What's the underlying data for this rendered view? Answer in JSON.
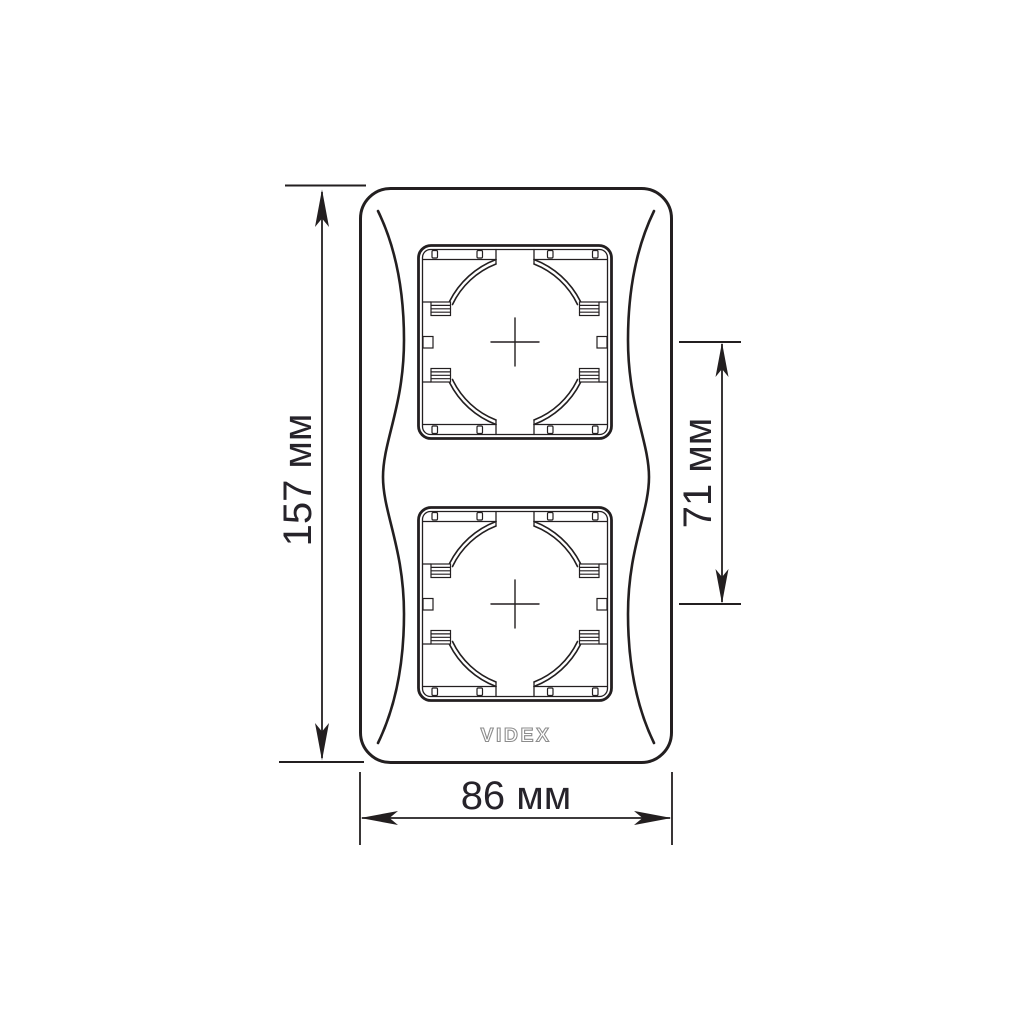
{
  "diagram": {
    "brand": "VIDEX",
    "subject": "2-gang vertical frame dimension drawing",
    "aperture_count": 2,
    "labels": {
      "height": "157 мм",
      "spacing": "71 мм",
      "width": "86 мм"
    },
    "colors": {
      "line": "#231f20",
      "background": "#ffffff",
      "logo_gray": "#8c8c8c"
    }
  }
}
